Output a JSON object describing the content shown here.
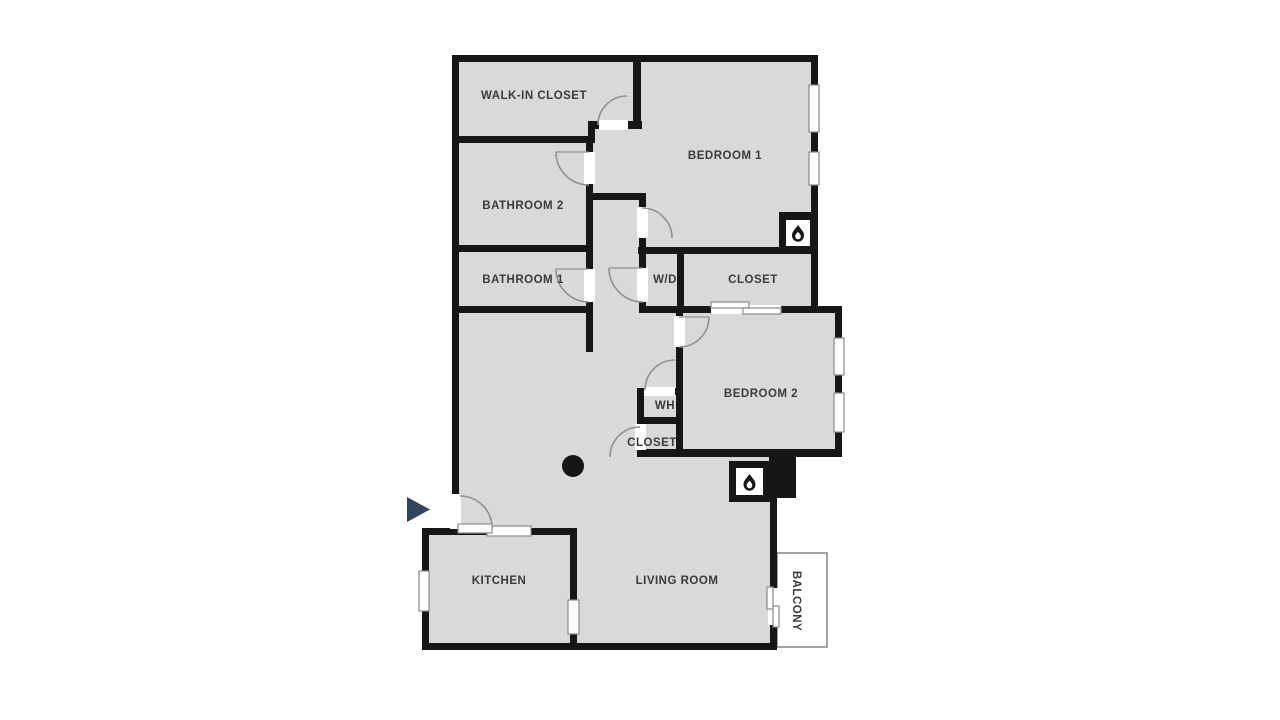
{
  "floorplan": {
    "rooms": [
      {
        "id": "walk-in-closet",
        "label": "WALK-IN CLOSET",
        "x": 534,
        "y": 96
      },
      {
        "id": "bedroom-1",
        "label": "BEDROOM 1",
        "x": 725,
        "y": 156
      },
      {
        "id": "bathroom-2",
        "label": "BATHROOM 2",
        "x": 523,
        "y": 206
      },
      {
        "id": "bathroom-1",
        "label": "BATHROOM 1",
        "x": 523,
        "y": 280
      },
      {
        "id": "washer-dryer",
        "label": "W/D",
        "x": 665,
        "y": 280
      },
      {
        "id": "closet-1",
        "label": "CLOSET",
        "x": 753,
        "y": 280
      },
      {
        "id": "bedroom-2",
        "label": "BEDROOM 2",
        "x": 761,
        "y": 394
      },
      {
        "id": "water-heater",
        "label": "WH",
        "x": 665,
        "y": 406
      },
      {
        "id": "closet-2",
        "label": "CLOSET",
        "x": 652,
        "y": 443
      },
      {
        "id": "kitchen",
        "label": "KITCHEN",
        "x": 499,
        "y": 581
      },
      {
        "id": "living-room",
        "label": "LIVING ROOM",
        "x": 677,
        "y": 581
      },
      {
        "id": "balcony",
        "label": "BALCONY",
        "x": 796,
        "y": 601,
        "vertical": true
      }
    ],
    "icons": [
      {
        "id": "entry-arrow-icon",
        "meaning": "unit entry direction"
      },
      {
        "id": "flame-icon-bedroom-1",
        "meaning": "fireplace"
      },
      {
        "id": "flame-icon-living-room",
        "meaning": "fireplace"
      },
      {
        "id": "column-dot",
        "meaning": "structural column"
      }
    ],
    "colors": {
      "background": "#ffffff",
      "wall": "#161616",
      "room_fill": "#d9d9d9",
      "label": "#3a3a3a",
      "door_arc": "#909090",
      "line": "#8a8a8a",
      "accent": "#31455c"
    }
  }
}
